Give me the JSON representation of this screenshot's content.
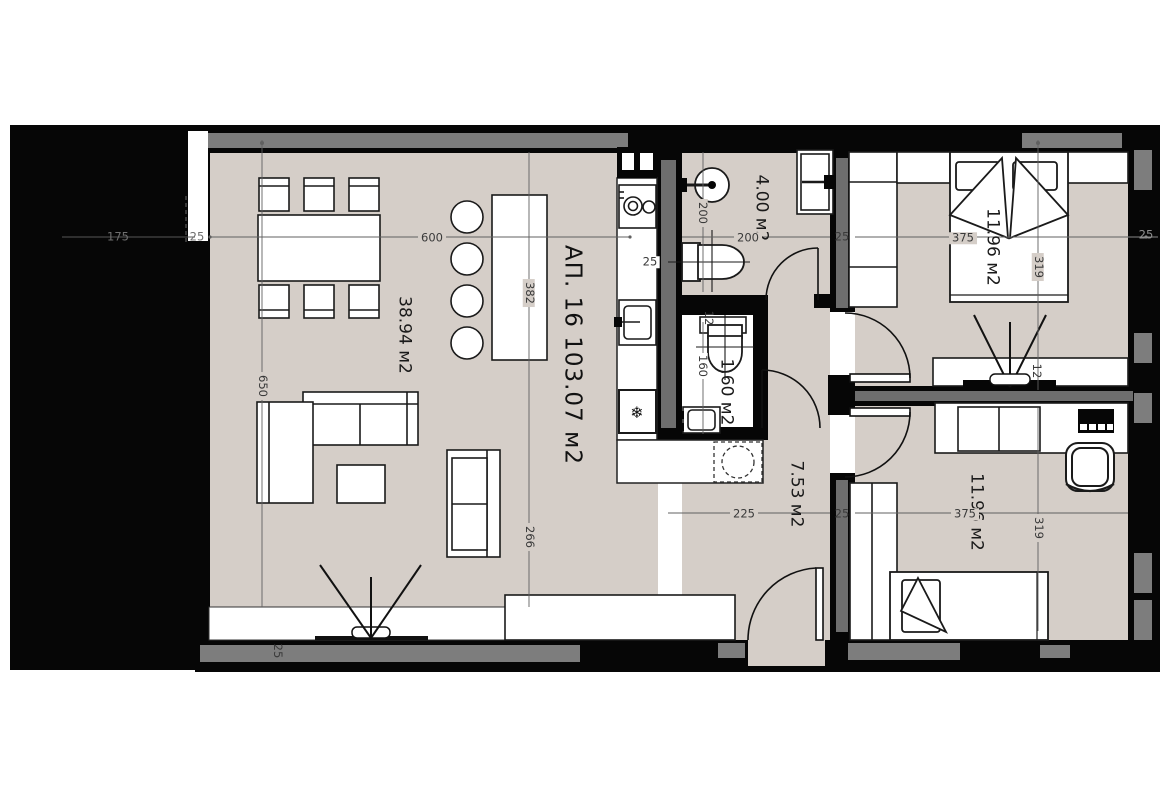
{
  "title": {
    "text": "АП. 16 103.07 м2"
  },
  "rooms": [
    {
      "name": "living-dining-kitchen",
      "label": "38.94 м2"
    },
    {
      "name": "bathroom",
      "label": "4.00 м2"
    },
    {
      "name": "wc",
      "label": "1.60 м2"
    },
    {
      "name": "hallway",
      "label": "7.53 м2"
    },
    {
      "name": "bedroom-top",
      "label": "11.96 м2"
    },
    {
      "name": "bedroom-bottom",
      "label": "11.96 м2"
    }
  ],
  "dimensions": [
    {
      "id": "left-offset",
      "text": "175"
    },
    {
      "id": "left-gap",
      "text": "25"
    },
    {
      "id": "living-width",
      "text": "600"
    },
    {
      "id": "island-length",
      "text": "382"
    },
    {
      "id": "living-height",
      "text": "650"
    },
    {
      "id": "living-lower-height",
      "text": "266"
    },
    {
      "id": "bottom-wall",
      "text": "25"
    },
    {
      "id": "kitchen-wall",
      "text": "25"
    },
    {
      "id": "bathroom-height",
      "text": "200"
    },
    {
      "id": "bathroom-width",
      "text": "200"
    },
    {
      "id": "mid-wall-top",
      "text": "25"
    },
    {
      "id": "bedroom-top-width",
      "text": "375"
    },
    {
      "id": "bedroom-top-height",
      "text": "319"
    },
    {
      "id": "right-wall-top",
      "text": "25"
    },
    {
      "id": "wc-shelf-depth",
      "text": "12"
    },
    {
      "id": "wc-height",
      "text": "160"
    },
    {
      "id": "tv-shelf-depth",
      "text": "12"
    },
    {
      "id": "hallway-width",
      "text": "225"
    },
    {
      "id": "mid-wall-bottom",
      "text": "25"
    },
    {
      "id": "bedroom-bottom-width",
      "text": "375"
    },
    {
      "id": "bedroom-bottom-height",
      "text": "319"
    }
  ],
  "icons": {
    "snowflake": "❄"
  },
  "colors": {
    "wall": "#060606",
    "floor": "#d5cec8",
    "accent_gray": "#7d7d7d",
    "line": "#1a1a1a"
  }
}
